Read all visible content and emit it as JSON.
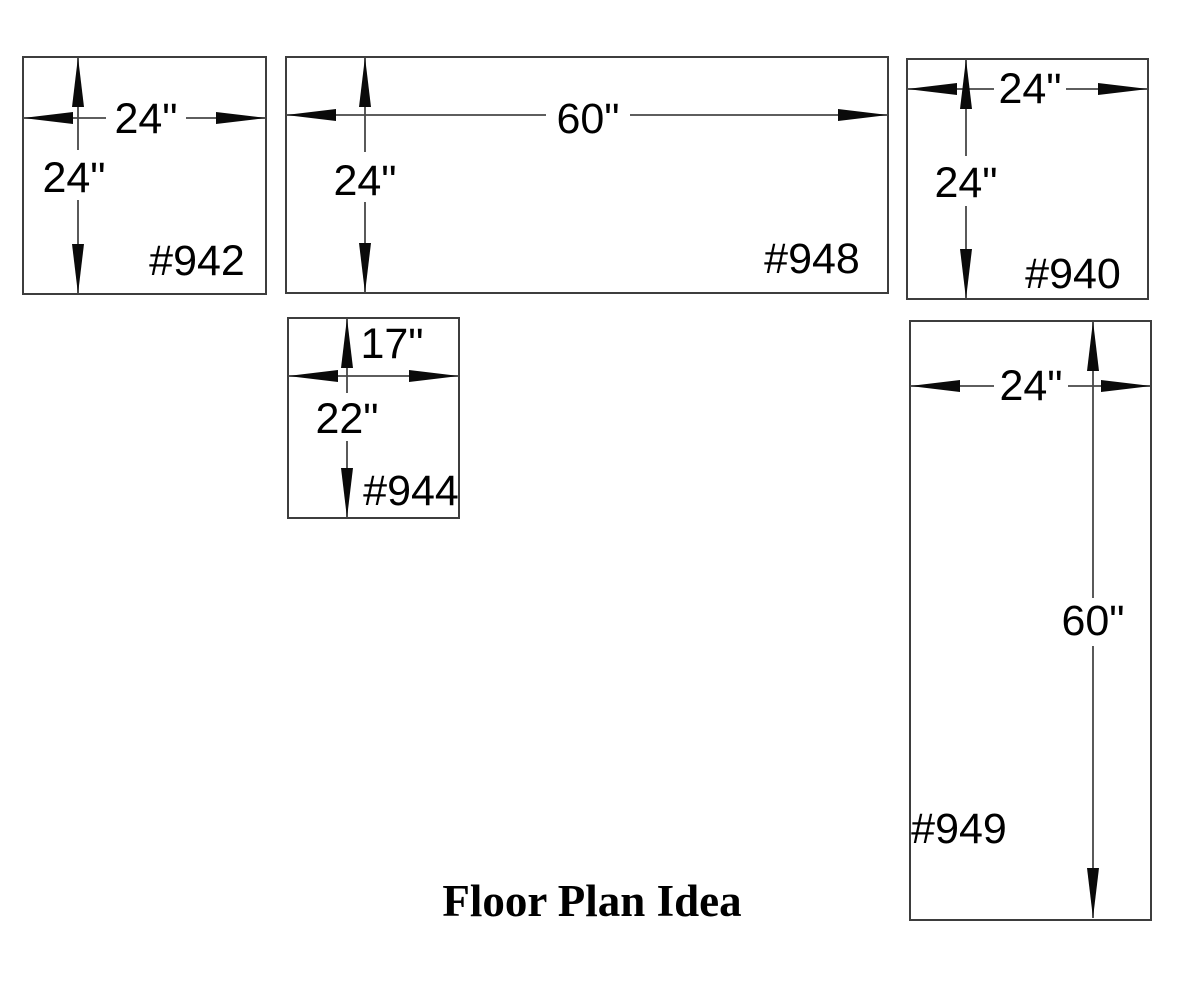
{
  "page": {
    "background_color": "#ffffff",
    "ink_color": "#000000",
    "line_color": "#3d3d3d"
  },
  "diagram": {
    "title": "Floor Plan Idea",
    "boxes": [
      {
        "id": "942",
        "label": "#942",
        "width": "24\"",
        "height": "24\""
      },
      {
        "id": "948",
        "label": "#948",
        "width": "60\"",
        "height": "24\""
      },
      {
        "id": "940",
        "label": "#940",
        "width": "24\"",
        "height": "24\""
      },
      {
        "id": "944",
        "label": "#944",
        "width": "17\"",
        "height": "22\""
      },
      {
        "id": "949",
        "label": "#949",
        "width": "24\"",
        "height": "60\""
      }
    ]
  }
}
